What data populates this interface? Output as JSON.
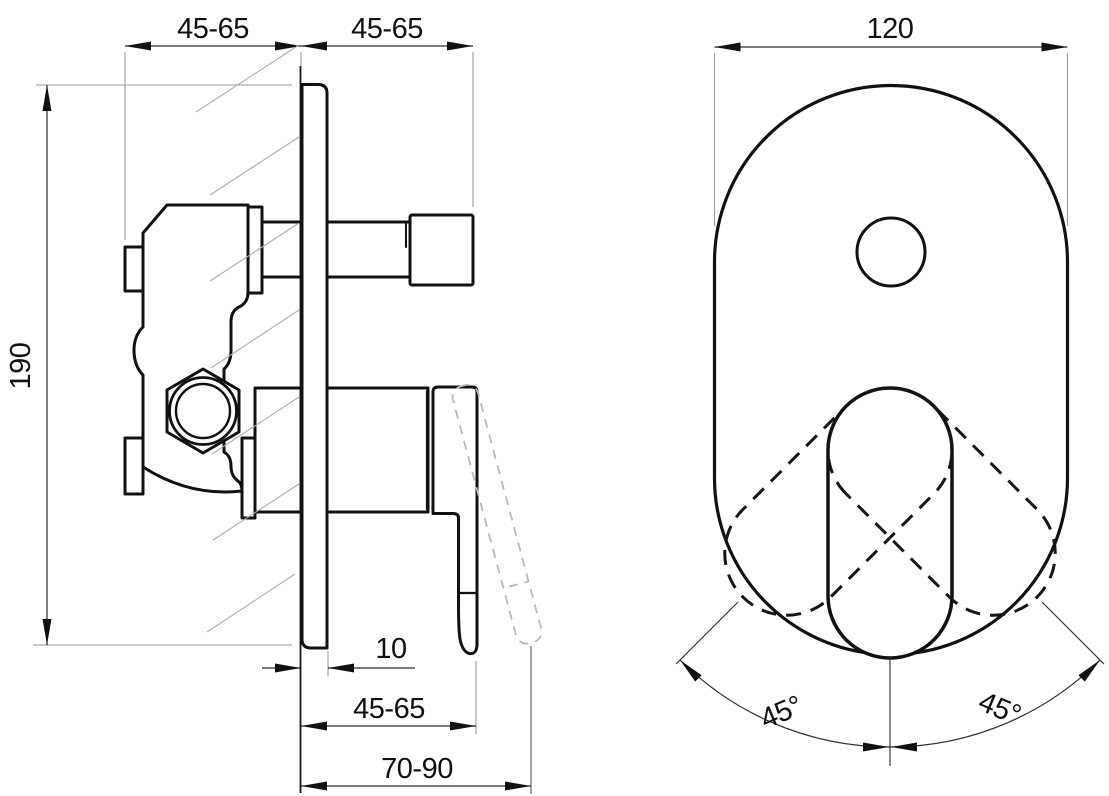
{
  "title": "Concealed shower mixer installation drawing",
  "side_view": {
    "label": "side view",
    "dims": {
      "top_left": "45-65",
      "top_right": "45-65",
      "height": "190",
      "plate_thickness": "10",
      "depth_min": "45-65",
      "depth_max": "70-90"
    }
  },
  "front_view": {
    "label": "front view",
    "dims": {
      "width": "120",
      "angle_left": "45°",
      "angle_right": "45°"
    }
  },
  "colors": {
    "background": "#ffffff",
    "outline": "#111111",
    "dimension": "#2a2a2a",
    "extension": "#9a9a9a",
    "hatch": "#adadad",
    "ghost_dashed": "#b9b9b9"
  }
}
